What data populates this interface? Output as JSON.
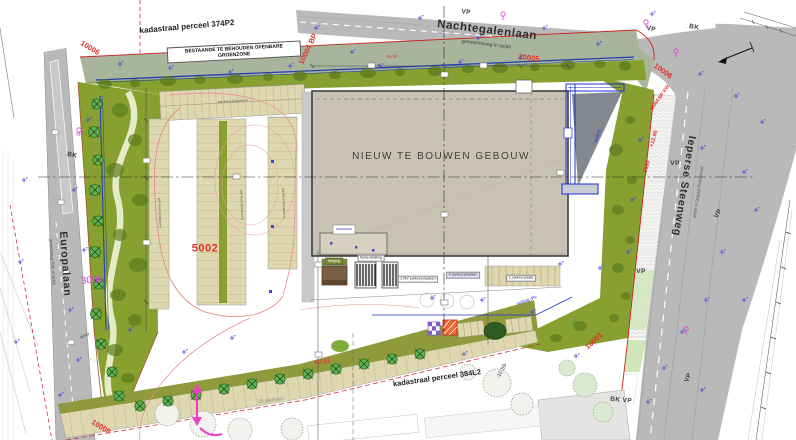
{
  "map": {
    "roads": {
      "nachtegalenlaan": {
        "name": "Nachtegalenlaan",
        "type": "gemeenteweg in asfalt"
      },
      "europalaan": {
        "name": "Europalaan",
        "type": "gewestweg (N8) in asfalt"
      },
      "ieperse_steenweg": {
        "name": "Ieperse Steenweg",
        "type": "gewestweg (N369) in asfalt"
      }
    },
    "parcels": {
      "north": "kadastraal perceel 374P2",
      "south": "kadastraal perceel 384L2"
    },
    "green_note": "BESTAANDE TE BEHOUDEN OPENBARE GROENZONE",
    "building_label": "NIEUW TE BOUWEN GEBOUW",
    "survey_numbers": [
      {
        "text": "10006",
        "x": 90,
        "y": 48,
        "rot": 31
      },
      {
        "text": "10004 BP",
        "x": 308,
        "y": 49,
        "rot": -64
      },
      {
        "text": "10005",
        "x": 529,
        "y": 58,
        "rot": 7
      },
      {
        "text": "10006",
        "x": 663,
        "y": 71,
        "rot": 36
      },
      {
        "text": "10004 BP KW",
        "x": 661,
        "y": 99,
        "rot": -55,
        "cls": "xs"
      },
      {
        "text": "10001",
        "x": 594,
        "y": 341,
        "rot": -43
      },
      {
        "text": "10008",
        "x": 101,
        "y": 427,
        "rot": 31
      }
    ],
    "road_marks": [
      {
        "text": "VP",
        "x": 466,
        "y": 13,
        "rot": 8
      },
      {
        "text": "VP",
        "x": 651,
        "y": 30,
        "rot": 10
      },
      {
        "text": "BK",
        "x": 694,
        "y": 28,
        "rot": 10
      },
      {
        "text": "BK",
        "x": 72,
        "y": 156,
        "rot": 10
      },
      {
        "text": "VP",
        "x": 675,
        "y": 164,
        "rot": 0
      },
      {
        "text": "VP",
        "x": 719,
        "y": 214,
        "rot": -60
      },
      {
        "text": "VP",
        "x": 641,
        "y": 272,
        "rot": 0
      },
      {
        "text": "BK VP",
        "x": 621,
        "y": 401,
        "rot": 6
      },
      {
        "text": "VP",
        "x": 689,
        "y": 378,
        "rot": -68
      }
    ],
    "annotations": [
      {
        "text": "3000",
        "x": 92,
        "y": 281,
        "rot": -4,
        "cls": "pinkbig"
      },
      {
        "text": "5002",
        "x": 205,
        "y": 249,
        "rot": 0,
        "cls": "red5002"
      },
      {
        "text": "3.50",
        "x": 80,
        "y": 134,
        "rot": -12,
        "cls": "pink"
      },
      {
        "text": "+11.51",
        "x": 322,
        "y": 363,
        "rot": -7,
        "cls": "redsm"
      },
      {
        "text": "25 plaatsen",
        "x": 271,
        "y": 401,
        "rot": -7,
        "cls": "gray"
      },
      {
        "text": "-10.59-",
        "x": 503,
        "y": 371,
        "rot": -62,
        "cls": "dark"
      },
      {
        "text": "+12.90",
        "x": 655,
        "y": 139,
        "rot": -74,
        "cls": "redsm"
      },
      {
        "text": "2000",
        "x": 648,
        "y": 167,
        "rot": -74,
        "cls": "redsm"
      },
      {
        "text": "150",
        "x": 575,
        "y": 322,
        "rot": -45,
        "cls": "greentxt"
      },
      {
        "text": "26.92",
        "x": 392,
        "y": 57,
        "rot": -2,
        "cls": "redxs"
      },
      {
        "text": "km/u",
        "x": 85,
        "y": 336,
        "rot": -28,
        "cls": "darkxs"
      },
      {
        "text": "2 MV parkeerplaatsen",
        "x": 418,
        "y": 279,
        "rot": 0,
        "cls": "box"
      },
      {
        "text": "4 parkeerplaatsen",
        "x": 463,
        "y": 275,
        "rot": 0,
        "cls": "box lav"
      },
      {
        "text": "1 parkeerplaats",
        "x": 521,
        "y": 278,
        "rot": 0,
        "cls": "box"
      },
      {
        "text": "fietsenstalling",
        "x": 371,
        "y": 258,
        "rot": 0,
        "cls": "box"
      },
      {
        "text": "berging",
        "x": 334,
        "y": 261,
        "rot": 0,
        "cls": "bar"
      },
      {
        "text": "parkeerplaatsen",
        "x": 159,
        "y": 213,
        "rot": 88,
        "cls": "rowlab"
      },
      {
        "text": "parkeerplaatsen",
        "x": 241,
        "y": 205,
        "rot": 88,
        "cls": "rowlab"
      },
      {
        "text": "parkeerplaatsen",
        "x": 283,
        "y": 203,
        "rot": 88,
        "cls": "rowlab"
      },
      {
        "text": "parkeerplaatsen",
        "x": 233,
        "y": 102,
        "rot": -3,
        "cls": "rowlab"
      },
      {
        "text": "helling 4%",
        "x": 527,
        "y": 301,
        "rot": -21,
        "cls": "bluetxt"
      },
      {
        "text": "helling",
        "x": 598,
        "y": 136,
        "rot": -76,
        "cls": "bluetxt"
      }
    ],
    "colors": {
      "parcel-red": "#e0312a",
      "magenta": "#d63cd6",
      "olive": "#87a02f",
      "road": "#b9b9b9",
      "building": "#c8c2b2",
      "blue": "#2233cc"
    }
  }
}
